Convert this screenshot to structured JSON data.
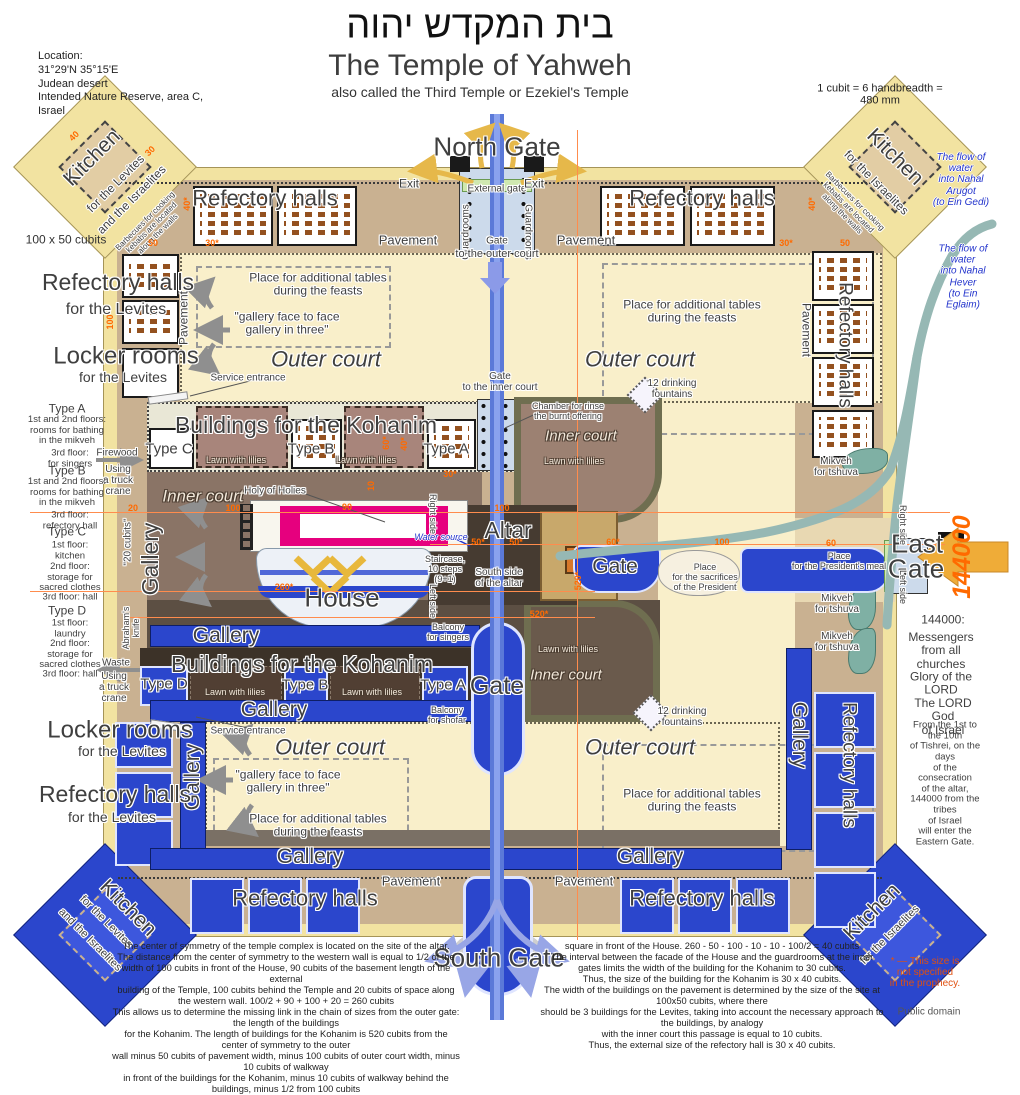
{
  "palette": {
    "blue": "#2b46cc",
    "cream": "#f9efca",
    "pavement": "#c9b191",
    "wall_yellow": "#f2e3a1",
    "orange": "#ff6a00",
    "teal": "#96b8b4",
    "magenta": "#e6007e",
    "gold": "#e8b83c"
  },
  "header": {
    "title_hebrew": "בית המקדש יהוה",
    "title": "The Temple of Yahweh",
    "subtitle": "also called the Third Temple or Ezekiel's Temple",
    "cubit_note": "1 cubit = 6 handbreadth = 480 mm",
    "location": "Location:\n31°29'N  35°15'E\nJudean desert\nIntended Nature Reserve, area C,\nIsrael"
  },
  "common": {
    "kitchen": "Kitchen",
    "for_levites": "for the Levites",
    "for_israelites": "for the Israelites",
    "and_israelites": "and the Israelites",
    "barbecue_note": "Barbecues for cooking\nkebabs are located\nalong the walls",
    "refectory": "Refectory halls",
    "locker": "Locker rooms",
    "pavement": "Pavement",
    "gallery": "Gallery",
    "outer_court": "Outer court",
    "inner_court": "Inner court",
    "lawn": "Lawn with lilies",
    "tables": "Place for additional tables\nduring the feasts",
    "quote": "\"gallery face to face\ngallery in three\"",
    "service": "Service entrance",
    "fountains": "12 drinking\nfountains",
    "mikveh": "Mikveh\nfor tshuva",
    "exit": "Exit",
    "guardrooms": "Guardrooms",
    "gate": "Gate",
    "right_side": "Right side",
    "left_side": "Left side",
    "truck": "Using\na truck\ncrane"
  },
  "north": {
    "title": "North Gate",
    "external_gate": "External gate",
    "to_outer_court": "to the outer court"
  },
  "south": {
    "title": "South Gate"
  },
  "east": {
    "line1": "East",
    "line2": "Gate",
    "big144000": "144000"
  },
  "center": {
    "kohanim": "Buildings for the Kohanim",
    "type_a": "Type A",
    "type_b": "Type B",
    "type_c": "Type C",
    "type_d": "Type D",
    "holy": "Holy of Holies",
    "altar": "Altar",
    "house": "House",
    "water_source": "Water source",
    "staircase": "Staircase,\n10 steps\n(9+1)",
    "south_side": "South side\nof the altar",
    "balcony_singers": "Balcony\nfor singers",
    "balcony_shofar": "Balcony\nfor shofar",
    "gate_to_inner": "Gate\nto the inner court",
    "chamber": "Chamber for rinse\nthe burnt offering",
    "sacrifices": "Place\nfor the sacrifices\nof the President",
    "presidents_meal": "Place\nfor the President's meal",
    "cubits20": "\"20 cubits\"",
    "abraham": "Abraham's\nknife",
    "firewood": "Firewood",
    "waste": "Waste",
    "dim_note": "100 x 50 cubits"
  },
  "types": {
    "a_title": "Type A",
    "a_l1": "1st and 2nd floors:\nrooms for bathing\nin the mikveh",
    "a_l2": "3rd floor:\nfor singers",
    "b_title": "Type B",
    "b_l1": "1st and 2nd floors:\nrooms for bathing\nin the mikveh",
    "b_l2": "3rd floor:\nrefectory hall",
    "c_title": "Type C",
    "c_l1": "1st floor:\nkitchen",
    "c_l2": "2nd floor:\nstorage for\nsacred clothes",
    "c_l3": "3rd floor: hall",
    "d_title": "Type D",
    "d_l1": "1st floor:\nlaundry",
    "d_l2": "2nd floor:\nstorage for\nsacred clothes",
    "d_l3": "3rd floor: hall"
  },
  "water": {
    "flow1": "The flow of water\ninto Nahal Arugot\n(to Ein Gedi)",
    "flow2": "The flow of water\ninto Nahal Hever\n(to Ein Eglaim)"
  },
  "right_col": {
    "n144000": "144000:",
    "messengers": "Messengers\nfrom all churches",
    "glory": "Glory of the LORD",
    "lord_god": "The LORD God\nof Israel",
    "tishrei": "From the 1st to the 10th\nof Tishrei, on the days\nof the consecration\nof the altar,\n144000 from the tribes\nof Israel\nwill enter the Eastern Gate."
  },
  "footer": {
    "para_left": "The center of symmetry of the temple complex is located on the site of the altar.\nThe distance from the center of symmetry to the western wall is equal to 1/2 of the\nwidth of 100 cubits in front of the House, 90 cubits of the basement length of the external\nbuilding of the Temple, 100 cubits behind the Temple and 20 cubits of space along\nthe western wall. 100/2 + 90 + 100 + 20 = 260 cubits\nThis allows us to determine the missing link in the chain of sizes from the outer gate: the length of the buildings\nfor the Kohanim. The length of buildings for the Kohanim is 520 cubits from the center of symmetry to the outer\nwall minus 50 cubits of pavement width, minus 100 cubits of outer court width, minus 10 cubits of walkway\nin front of the buildings for the Kohanim, minus 10 cubits of walkway behind the buildings, minus 1/2 from 100 cubits",
    "para_right": "square in front of the House. 260 - 50 - 100 - 10 - 10 - 100/2 = 40 cubits\nThe interval between the facade of the House and the guardrooms at the inner\ngates limits the width of the building for the Kohanim to 30 cubits.\nThus, the size of the building for the Kohanim is 30 x 40 cubits.\nThe width of the buildings on the pavement is determined by the size of the site at 100x50 cubits, where there\nshould be 3 buildings for the Levites, taking into account the necessary approach to the buildings, by analogy\nwith the inner court this passage is equal to 10 cubits.\nThus, the external size of the refectory hall is 30 x 40 cubits.",
    "size_note": "* — This size is\nnot specified\nin the prophecy.",
    "public_domain": "Public domain"
  },
  "dims": {
    "d40": "40",
    "d30": "30",
    "d50": "50",
    "d30s": "30*",
    "d40s": "40*",
    "d100": "100",
    "d20": "20",
    "d90": "90",
    "d60": "60",
    "d60s": "60*",
    "d50s": "50*",
    "d10": "10",
    "d260s": "260*",
    "d520s": "520*"
  }
}
